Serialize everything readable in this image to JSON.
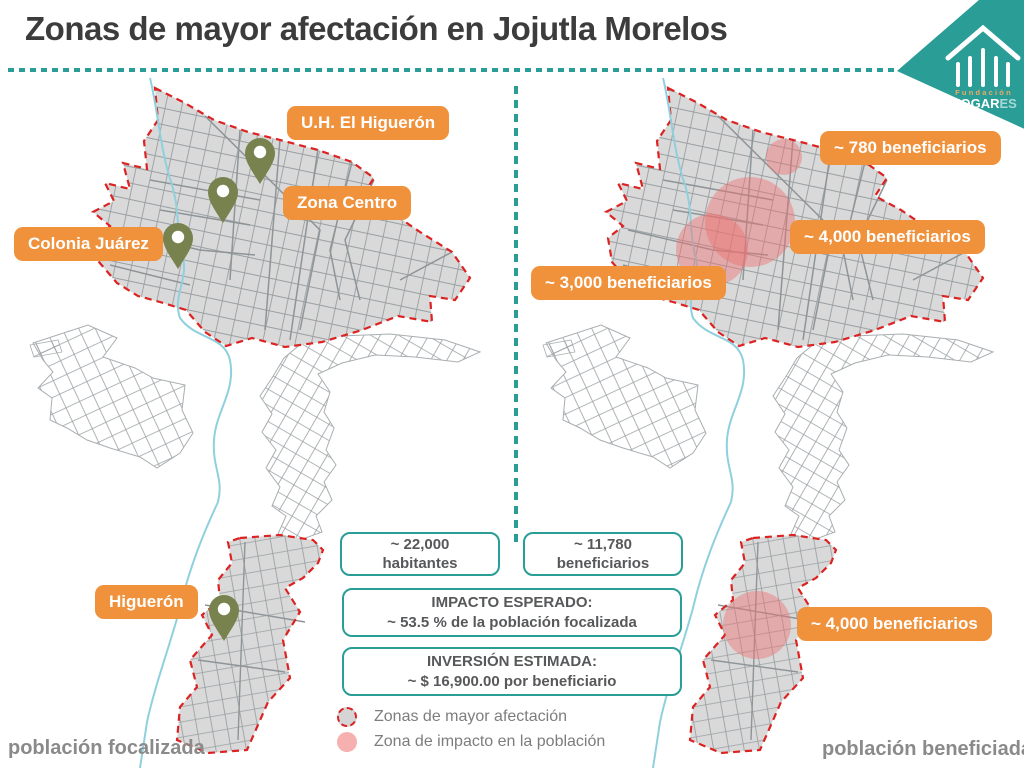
{
  "title": "Zonas de mayor afectación en Jojutla Morelos",
  "logo": {
    "fundacion": "Fundación",
    "hogar": "HOGAR",
    "es": "ES"
  },
  "left_map": {
    "caption": "población focalizada",
    "labels": [
      {
        "text": "U.H. El Higuerón"
      },
      {
        "text": "Zona Centro"
      },
      {
        "text": "Colonia Juárez"
      },
      {
        "text": "Higuerón"
      }
    ]
  },
  "right_map": {
    "caption": "población beneficiada",
    "labels": [
      {
        "text": "~ 780 beneficiarios"
      },
      {
        "text": "~ 4,000 beneficiarios"
      },
      {
        "text": "~ 3,000 beneficiarios"
      },
      {
        "text": "~ 4,000 beneficiarios"
      }
    ]
  },
  "stats": {
    "habitantes": {
      "line1": "~ 22,000",
      "line2": "habitantes"
    },
    "beneficiarios": {
      "line1": "~ 11,780",
      "line2": "beneficiarios"
    },
    "impacto": {
      "line1": "IMPACTO ESPERADO:",
      "line2": "~ 53.5 % de la población focalizada"
    },
    "inversion": {
      "line1": "INVERSIÓN ESTIMADA:",
      "line2": "~ $ 16,900.00 por beneficiario"
    }
  },
  "legend": [
    {
      "label": "Zonas de mayor afectación"
    },
    {
      "label": "Zona de impacto en la población"
    }
  ],
  "colors": {
    "teal": "#2a9d96",
    "orange": "#f0913c",
    "red_outline": "#dd2222",
    "pink_zone": "#ee7070",
    "pin_olive": "#78824e",
    "map_gray": "#d9d9d9",
    "river_blue": "#8fd0de",
    "title_text": "#3c3c3c",
    "body_text": "#57585a"
  }
}
